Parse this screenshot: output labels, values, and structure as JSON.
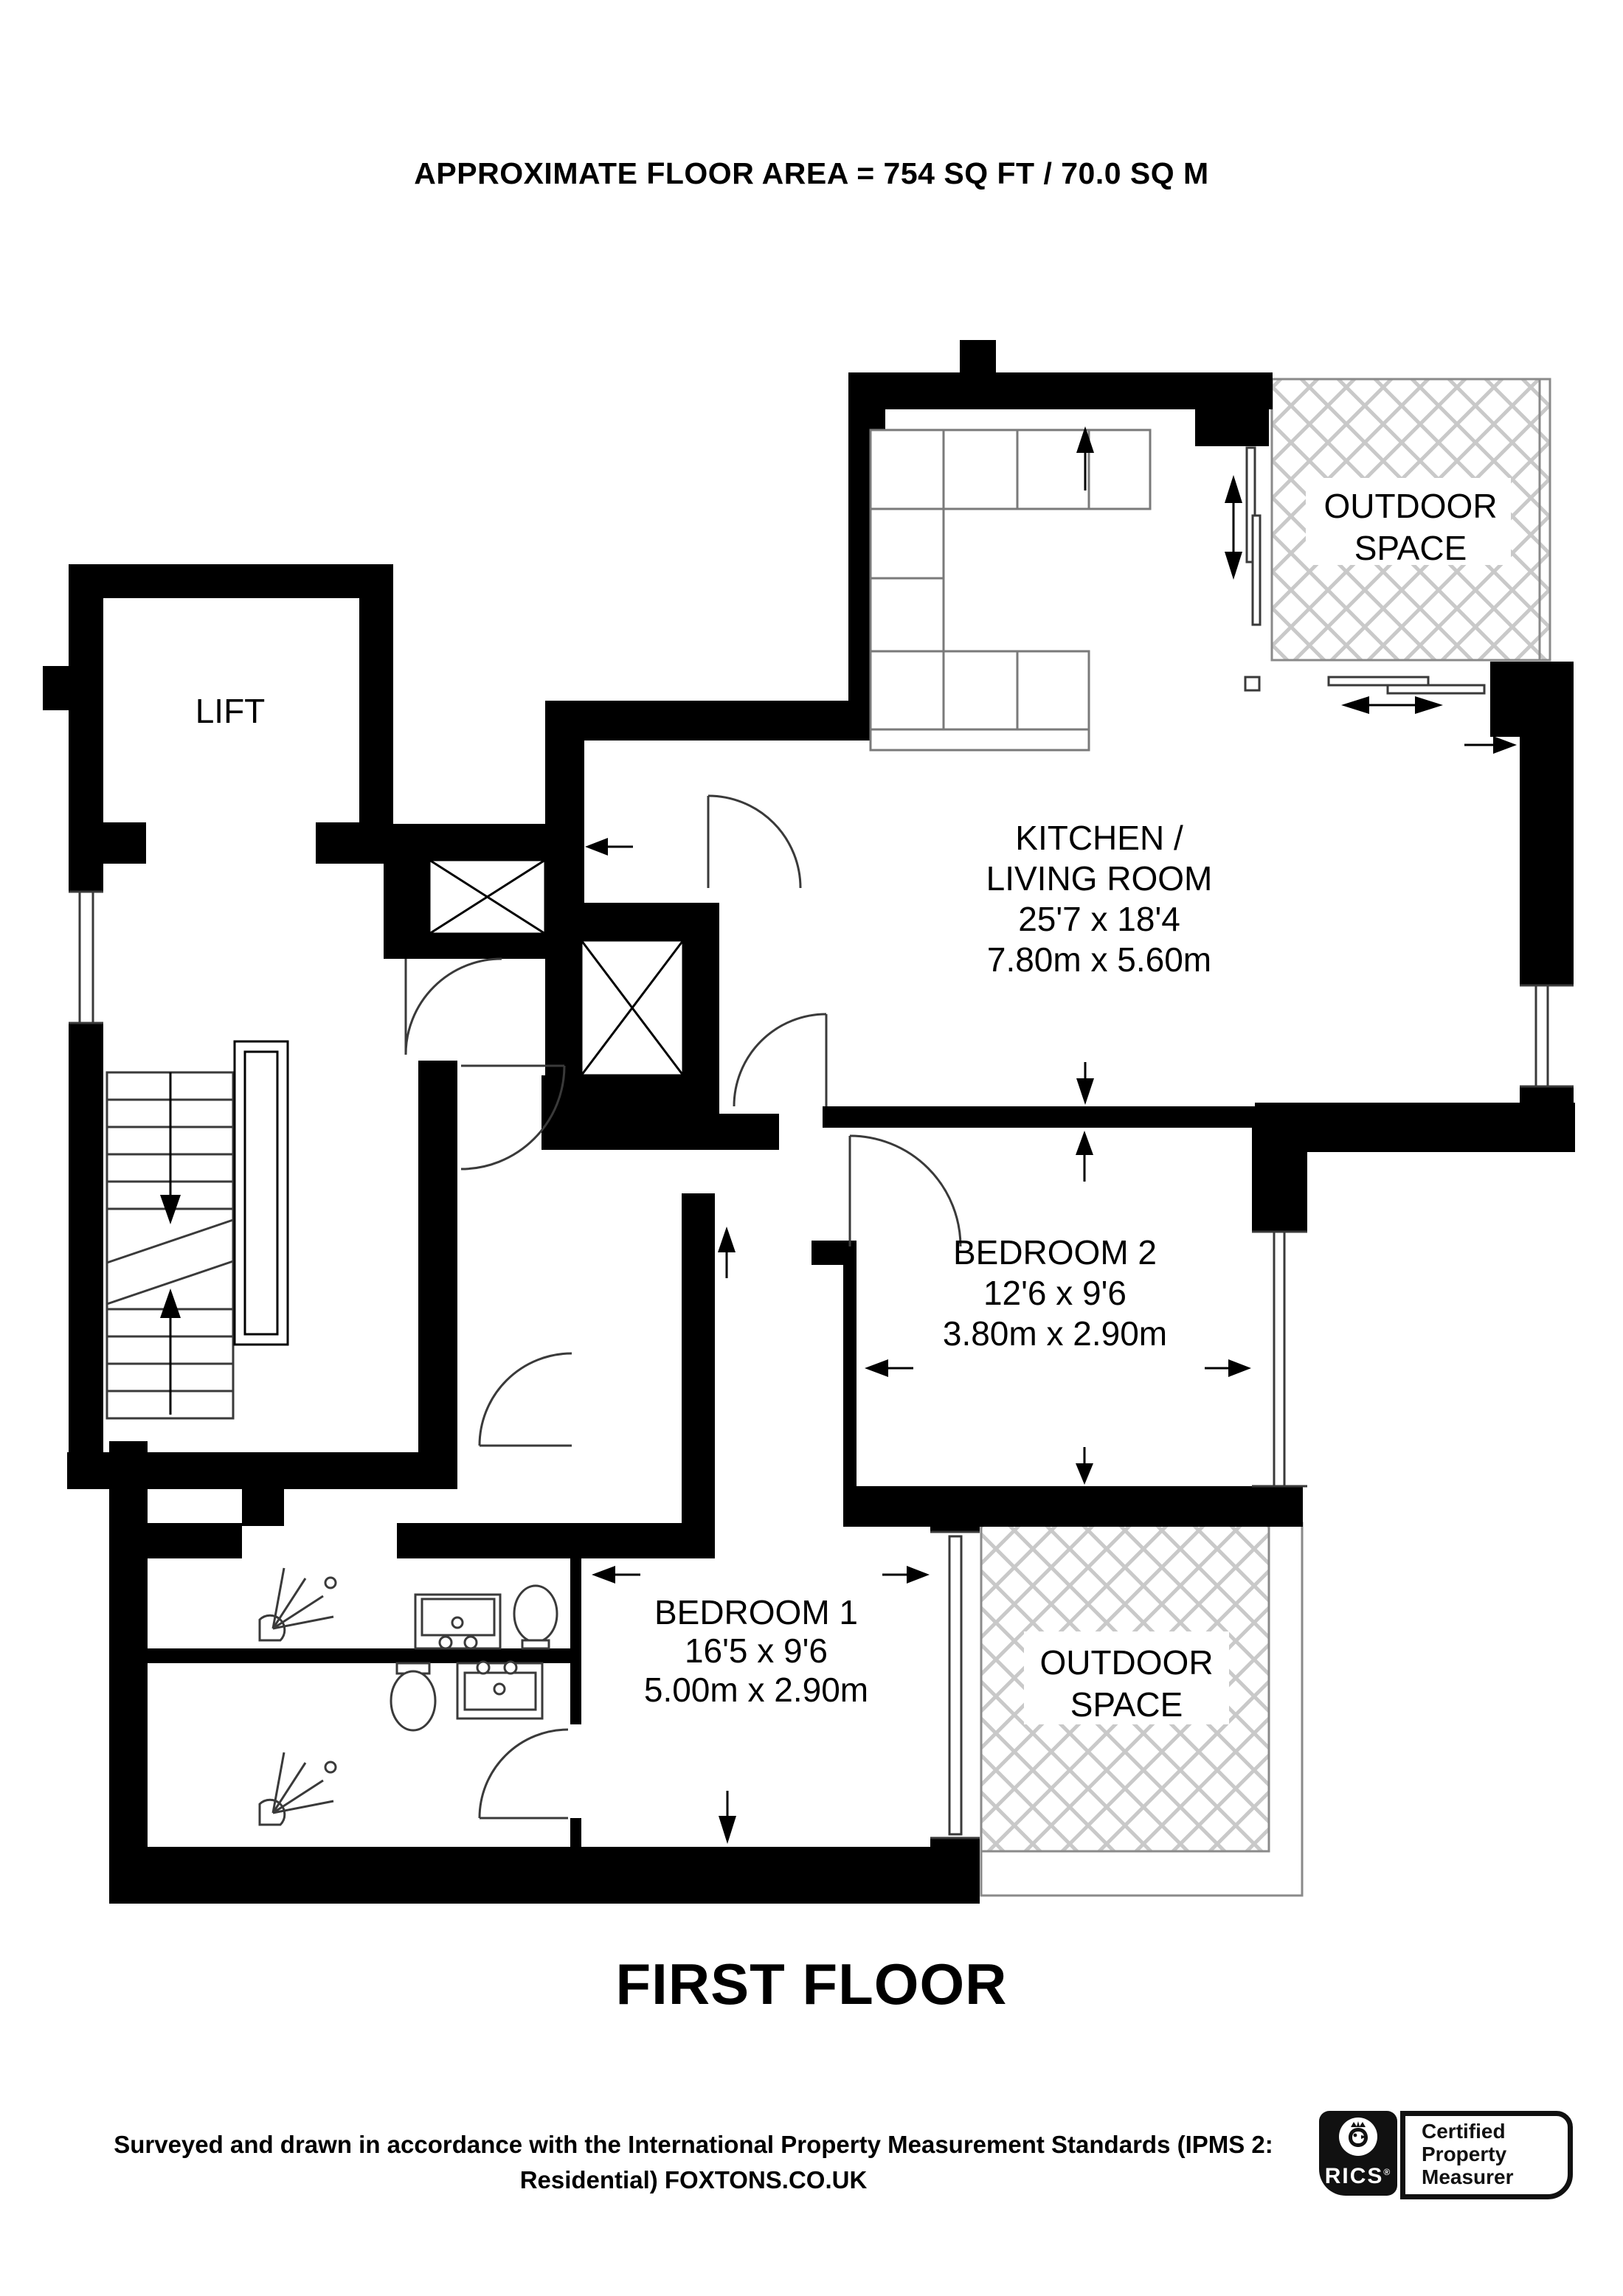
{
  "title": "APPROXIMATE FLOOR AREA = 754 SQ FT / 70.0 SQ M",
  "floor_label": "FIRST FLOOR",
  "footer": {
    "line1": "Surveyed and drawn in accordance with the International Property Measurement Standards (IPMS 2:",
    "line2": "Residential) FOXTONS.CO.UK"
  },
  "rooms": {
    "lift": {
      "name": "LIFT"
    },
    "kitchen": {
      "name_line1": "KITCHEN /",
      "name_line2": "LIVING ROOM",
      "dim_imperial": "25'7 x 18'4",
      "dim_metric": "7.80m x 5.60m"
    },
    "bedroom2": {
      "name": "BEDROOM 2",
      "dim_imperial": "12'6 x 9'6",
      "dim_metric": "3.80m x 2.90m"
    },
    "bedroom1": {
      "name": "BEDROOM 1",
      "dim_imperial": "16'5 x 9'6",
      "dim_metric": "5.00m x 2.90m"
    },
    "outdoor_top": {
      "line1": "OUTDOOR",
      "line2": "SPACE"
    },
    "outdoor_bottom": {
      "line1": "OUTDOOR",
      "line2": "SPACE"
    }
  },
  "badges": {
    "rics": {
      "brand": "RICS",
      "reg": "®"
    },
    "certification": {
      "line1": "Certified",
      "line2": "Property",
      "line3": "Measurer"
    }
  },
  "colors": {
    "wall": "#000000",
    "hatch": "#c9c9c9",
    "fixture": "#3a3a3a",
    "counter": "#7a7a7a"
  }
}
